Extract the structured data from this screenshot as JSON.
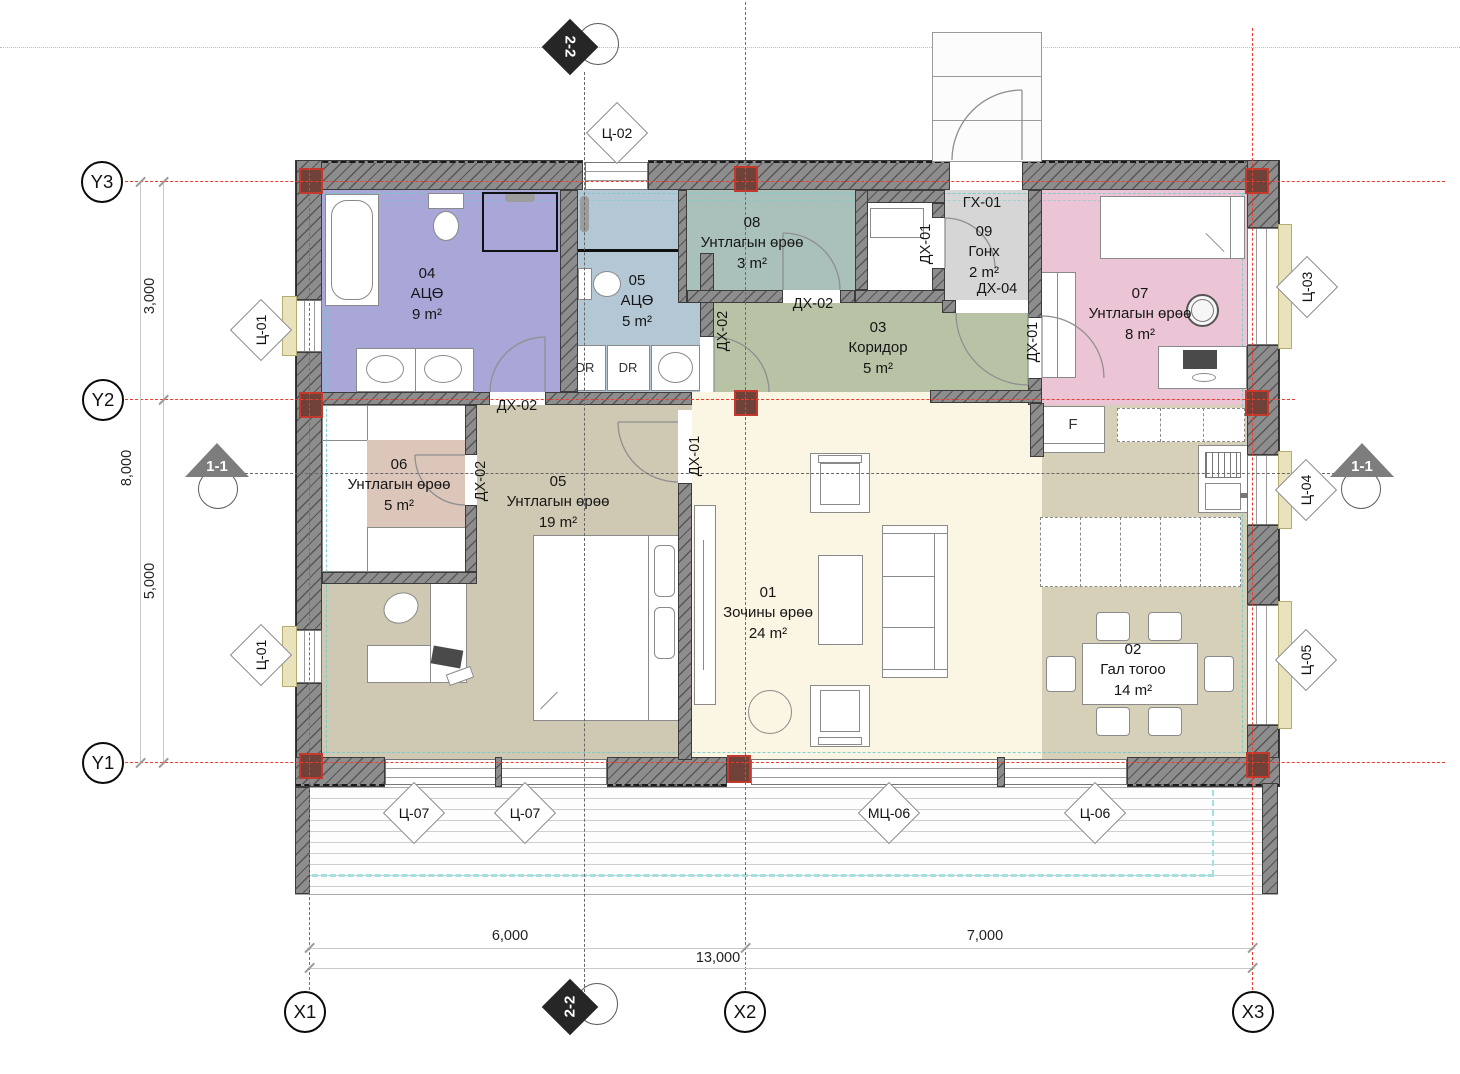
{
  "axes": {
    "y": [
      {
        "label": "Y3"
      },
      {
        "label": "Y2"
      },
      {
        "label": "Y1"
      }
    ],
    "x": [
      {
        "label": "X1"
      },
      {
        "label": "X2"
      },
      {
        "label": "X3"
      }
    ]
  },
  "dimensions": {
    "left_span_top": "3,000",
    "left_total": "8,000",
    "left_span_bottom": "5,000",
    "bottom_span_left": "6,000",
    "bottom_span_right": "7,000",
    "bottom_total": "13,000"
  },
  "sections": {
    "vertical": "2-2",
    "horizontal": "1-1"
  },
  "rooms": [
    {
      "number": "01",
      "name": "Зочины өрөө",
      "area": "24 m²",
      "color": "#faf6e3"
    },
    {
      "number": "02",
      "name": "Гал тогоо",
      "area": "14 m²",
      "color": "#d6d0b9"
    },
    {
      "number": "03",
      "name": "Коридор",
      "area": "5 m²",
      "color": "#b8c3a6"
    },
    {
      "number": "04",
      "name": "АЦӨ",
      "area": "9 m²",
      "color": "#a9a6d8"
    },
    {
      "number": "05",
      "name": "АЦӨ",
      "area": "5 m²",
      "color": "#b3c7d4"
    },
    {
      "number": "05",
      "name": "Унтлагын өрөө",
      "area": "19 m²",
      "color": "#cfc9b3"
    },
    {
      "number": "06",
      "name": "Унтлагын өрөө",
      "area": "5 m²",
      "color": "#dcc6ba"
    },
    {
      "number": "07",
      "name": "Унтлагын өрөө",
      "area": "8 m²",
      "color": "#ebc5d6"
    },
    {
      "number": "08",
      "name": "Унтлагын өрөө",
      "area": "3 m²",
      "color": "#aac1bb"
    },
    {
      "number": "09",
      "name": "Гонх",
      "area": "2 m²",
      "color": "#d6d6d6"
    }
  ],
  "door_tags": {
    "gh01": "ГХ-01",
    "dh01": "ДХ-01",
    "dh02": "ДХ-02",
    "dh04": "ДХ-04"
  },
  "window_tags": {
    "c01": "Ц-01",
    "c02": "Ц-02",
    "c03": "Ц-03",
    "c04": "Ц-04",
    "c05": "Ц-05",
    "c06": "Ц-06",
    "c07": "Ц-07",
    "mc06": "МЦ-06"
  },
  "furniture_labels": {
    "dr": "DR",
    "fridge": "F"
  },
  "colors": {
    "grid_line": "#ee3b2b",
    "wall": "#8d8d8d",
    "column": "#6f4138",
    "guide_cyan": "#74cccc",
    "guide_olive": "#9a8c3c",
    "window_sill": "#e9e3bd"
  }
}
